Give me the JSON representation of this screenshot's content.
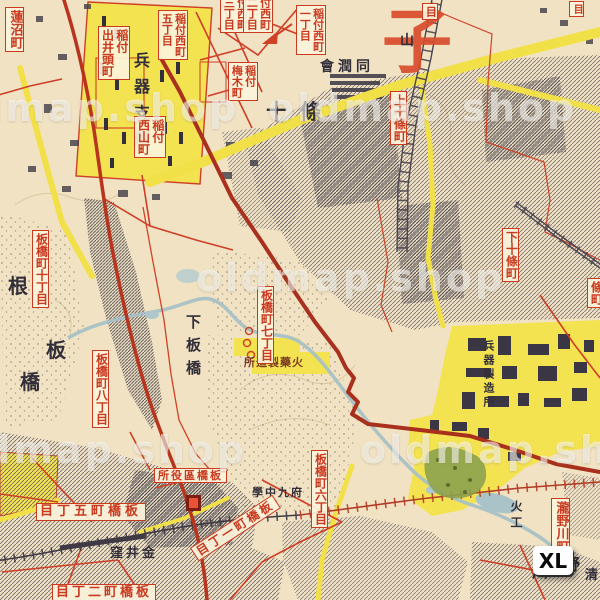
{
  "map_type": "vintage-japanese-city-map",
  "watermark": {
    "text": "oldmap.shop"
  },
  "badge": {
    "label": "XL"
  },
  "big_label": {
    "text": "子"
  },
  "red_boxed_labels": {
    "hasunuma": {
      "text": "蓮沼町"
    },
    "inatsuke_deiigashira": {
      "col1": "稲付",
      "col2": "出井頭町"
    },
    "inatsuke_nishi_5": {
      "col1": "稲付西町",
      "col2": "五丁目"
    },
    "inatsuke_nishi_3": {
      "col1": "付西町",
      "col2": "三丁目"
    },
    "inatsuke_nishi_2": {
      "col1": "付西町",
      "col2": "二丁目"
    },
    "inatsuke_nishi_1": {
      "col1": "稲付西町",
      "col2": "一丁目"
    },
    "inatsuke_nishiyama": {
      "col1": "稲付",
      "col2": "西山町"
    },
    "inatsuke_umeki": {
      "col1": "稲付",
      "col2": "梅木町"
    },
    "itabashi_10": {
      "text": "板橋町十丁目"
    },
    "itabashi_8": {
      "text": "板橋町八丁目"
    },
    "itabashi_7": {
      "text": "板橋町七丁目"
    },
    "itabashi_6": {
      "text": "板橋町六丁目"
    },
    "itabashi_5": {
      "text": "目丁五町橋板"
    },
    "itabashi_2": {
      "text": "目丁二町橋板"
    },
    "itabashi_1": {
      "text": "目丁一町橋板"
    },
    "ward_office": {
      "text": "所役區橋板"
    },
    "kami_jujo": {
      "text": "上十條町"
    },
    "shimo_jujo": {
      "text": "下十條町"
    },
    "takinogawa": {
      "text": "瀧野川町"
    },
    "jo_edge": {
      "text": "條町"
    },
    "me_edge_1": {
      "text": "目"
    },
    "me_edge_2": {
      "text": "目"
    }
  },
  "black_labels": {
    "heiki_shisho": "兵器支廠",
    "dojunkai": "會潤同",
    "jujo": "十條",
    "yama": "山",
    "shimo_itabashi": "下板橋",
    "ne": "根",
    "ita": "板",
    "hashi": "橋",
    "kanaikubo": "窪井金",
    "furitsu_9chu": "學中九府",
    "kayaku_seizojo": "所造製藥火",
    "heiki_seizojo": "兵器製造所",
    "kako": "火工",
    "no": "野",
    "kawa": "川",
    "kiyo": "清",
    "elevation": "29.0"
  },
  "colors": {
    "paper": "#f0e2c2",
    "zone_yellow": "#f4e351",
    "road_red": "#cf3e27",
    "rail_brick": "#a8301d",
    "river_blue": "#a6c0c6",
    "park_green": "#8da24e",
    "label_red": "#c93a20",
    "building_ink": "#4a4550",
    "watermark_white": "rgba(255,255,255,0.55)"
  }
}
